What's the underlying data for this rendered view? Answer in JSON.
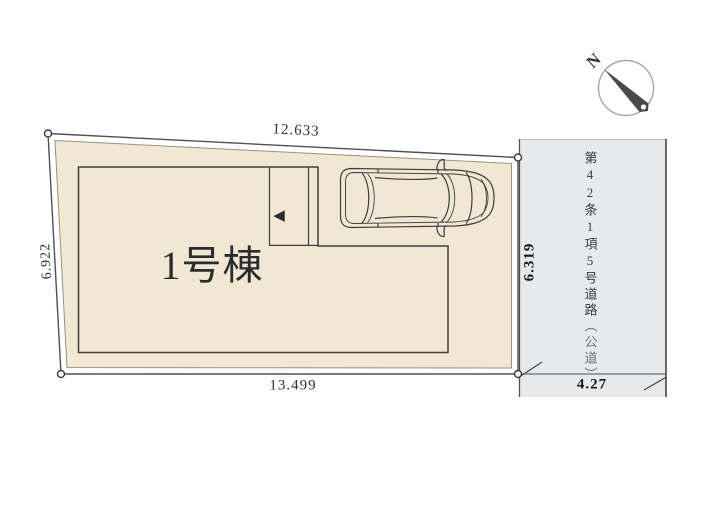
{
  "plan": {
    "building": {
      "label": "1号棟",
      "entrance_marker": "◀"
    },
    "dimensions": {
      "top": "12.633",
      "bottom": "13.499",
      "left": "6.922",
      "right": "6.319",
      "road_width": "4.27"
    },
    "road": {
      "label_main": "第42条1項5号道路",
      "label_paren": "（公道）"
    },
    "compass": {
      "label": "N"
    },
    "colors": {
      "lot_fill": "#f1e7d2",
      "road_fill": "#e8e9eb",
      "boundary_line": "#4e5054",
      "building_line": "#3c3e42",
      "text": "#2e2f31"
    }
  }
}
